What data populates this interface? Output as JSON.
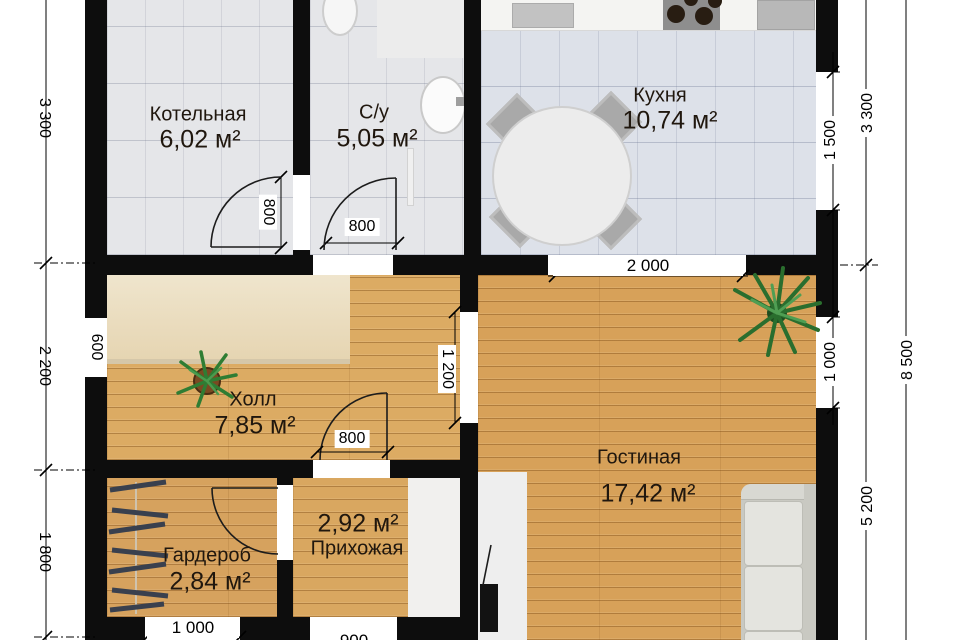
{
  "plan_title": "Floor plan, 1st floor",
  "rooms": [
    {
      "name": "Котельная",
      "area": "6,02 м²"
    },
    {
      "name": "С/у",
      "area": "5,05 м²"
    },
    {
      "name": "Кухня",
      "area": "10,74 м²"
    },
    {
      "name": "Холл",
      "area": "7,85 м²"
    },
    {
      "name": "Гостиная",
      "area": "17,42 м²"
    },
    {
      "name": "Гардероб",
      "area": "2,84 м²"
    },
    {
      "name": "Прихожая",
      "area": "2,92 м²"
    }
  ],
  "dims": {
    "left_top": "3 300",
    "left_mid": "2 200",
    "left_bottom": "1 800",
    "window_600": "600",
    "right_window_kitchen": "1 500",
    "right_window_living": "1 000",
    "right_top": "3 300",
    "right_bottom": "5 200",
    "right_total": "8 500",
    "opening_2000": "2 000",
    "opening_1200": "1 200",
    "door_boiler": "800",
    "door_bath": "800",
    "door_hall": "800",
    "bottom_window": "1 000",
    "bottom_door": "900"
  },
  "colors": {
    "wall": "#0d0d0d",
    "wood_floor": "#d9a55c",
    "tile_floor": "#e5e6e9",
    "kitchen_tile": "#dde1e9",
    "rug": "#ead9b8",
    "plant_green": "#2f7d33",
    "sofa": "#dededa"
  }
}
